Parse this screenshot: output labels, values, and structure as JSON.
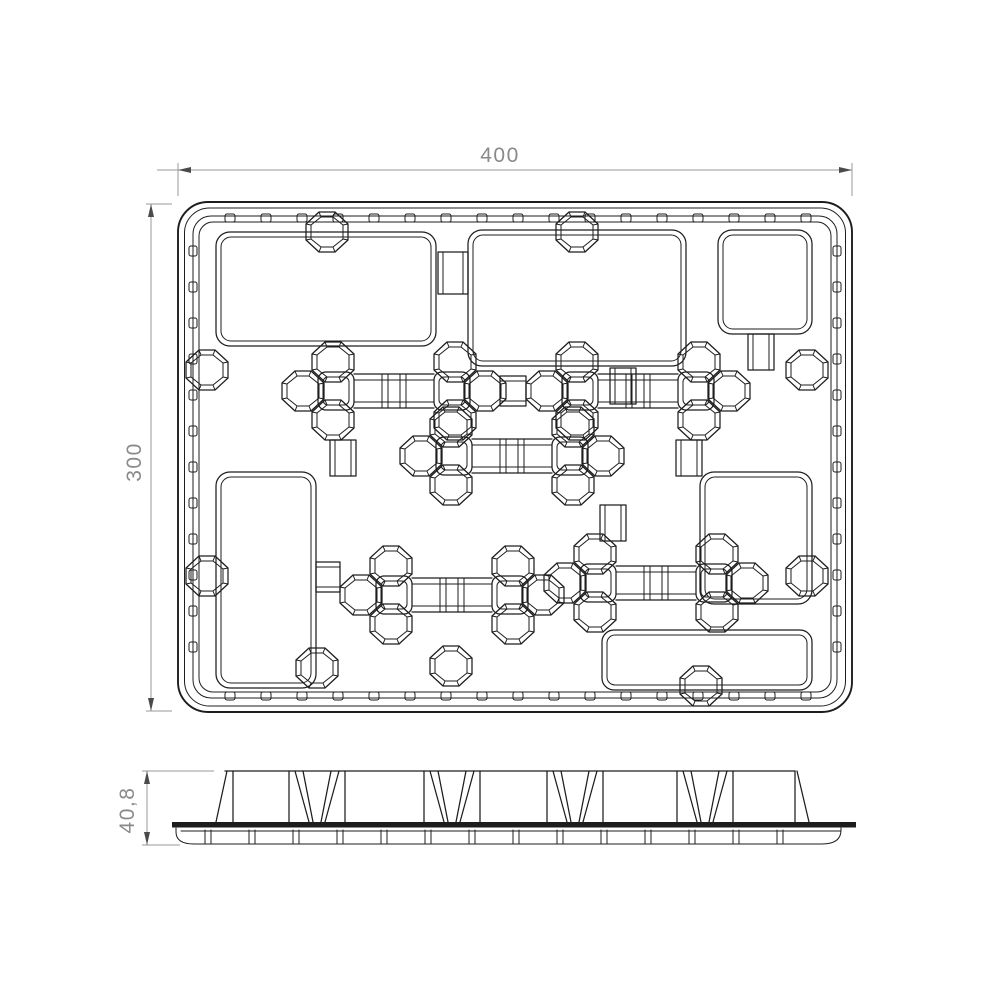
{
  "drawing": {
    "dim_width_label": "400",
    "dim_height_label": "300",
    "dim_thickness_label": "40,8"
  },
  "colors": {
    "line": "#1d1d1d",
    "dim_line": "#9a9a9a",
    "dim_text": "#8a8a8a",
    "arrow": "#4a4a4a",
    "background": "#ffffff"
  }
}
